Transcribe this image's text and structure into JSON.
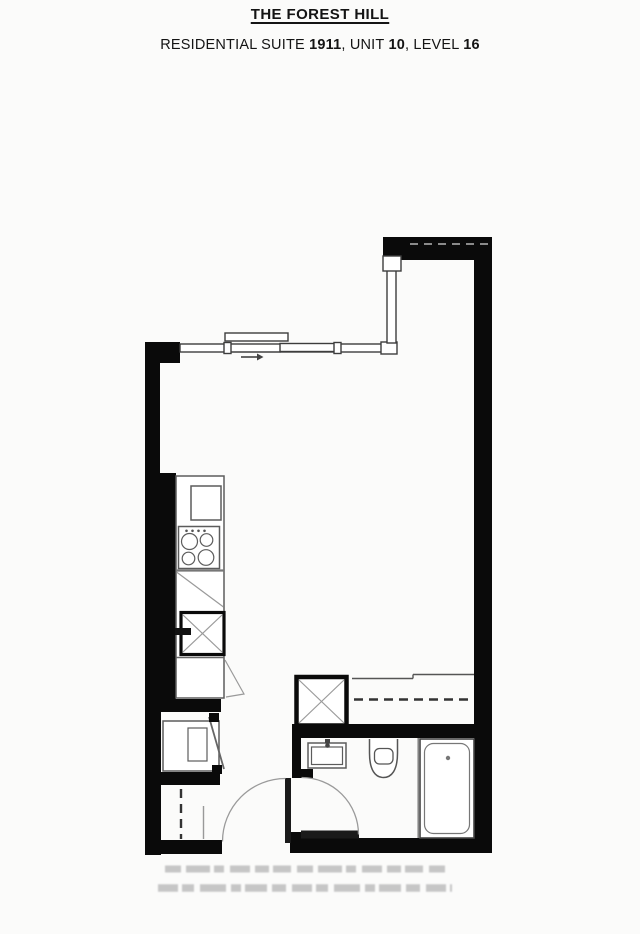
{
  "header": {
    "building_name": "THE FOREST HILL",
    "suite_prefix": "RESIDENTIAL SUITE ",
    "suite_number": "1911",
    "unit_prefix": ", UNIT ",
    "unit_number": "10",
    "level_prefix": ", LEVEL ",
    "level_number": "16"
  },
  "floorplan": {
    "drawing_type": "residential-suite-floor-plan",
    "fixtures": [
      "window-wall",
      "sliding-balcony-door",
      "slide-direction-arrow",
      "kitchen-counter",
      "kitchen-sink",
      "cooktop",
      "dishwasher",
      "oven-appliance",
      "kitchen-cabinet",
      "washer-dryer",
      "laundry-closet-door",
      "wardrobe-closet-rod",
      "mechanical-shaft",
      "linen-closet-rod",
      "bathroom-vanity",
      "toilet",
      "bathtub",
      "entry-door-swing",
      "bathroom-door-swing"
    ],
    "disclaimer_legible": false
  },
  "theme": {
    "wall": "#0a0a0a",
    "leaf": "#1a1a1a",
    "line_dark": "#3d3d3d",
    "line_mid": "#5c5c5c",
    "line_light": "#9a9a9a",
    "paper": "#fbfbfa",
    "smudge": "#c6c6c6"
  }
}
